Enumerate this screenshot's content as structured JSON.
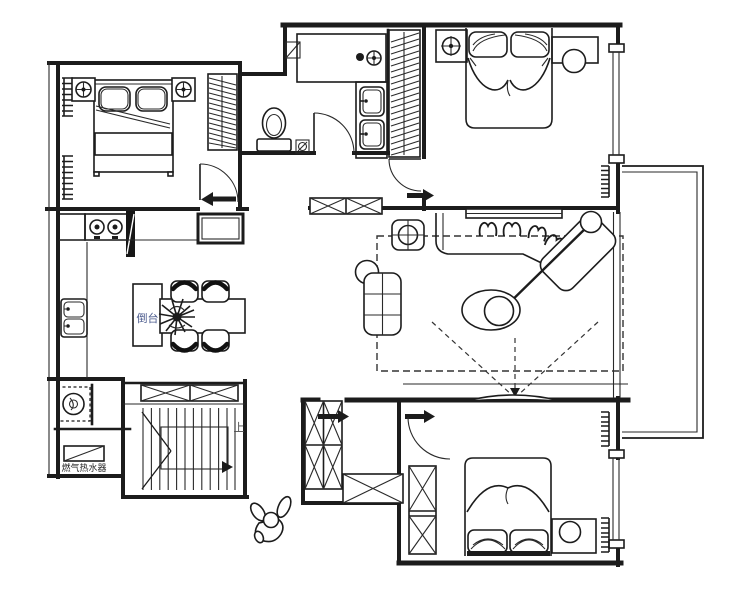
{
  "labels": {
    "island": "倒台",
    "stairs_up": "上",
    "water_heater": "燃气热水器"
  },
  "colors": {
    "line": "#1c1c1c",
    "island_text": "#4a5a8c",
    "stairs_text": "#4a4a4a",
    "heater_text": "#262626",
    "background": "#ffffff"
  }
}
